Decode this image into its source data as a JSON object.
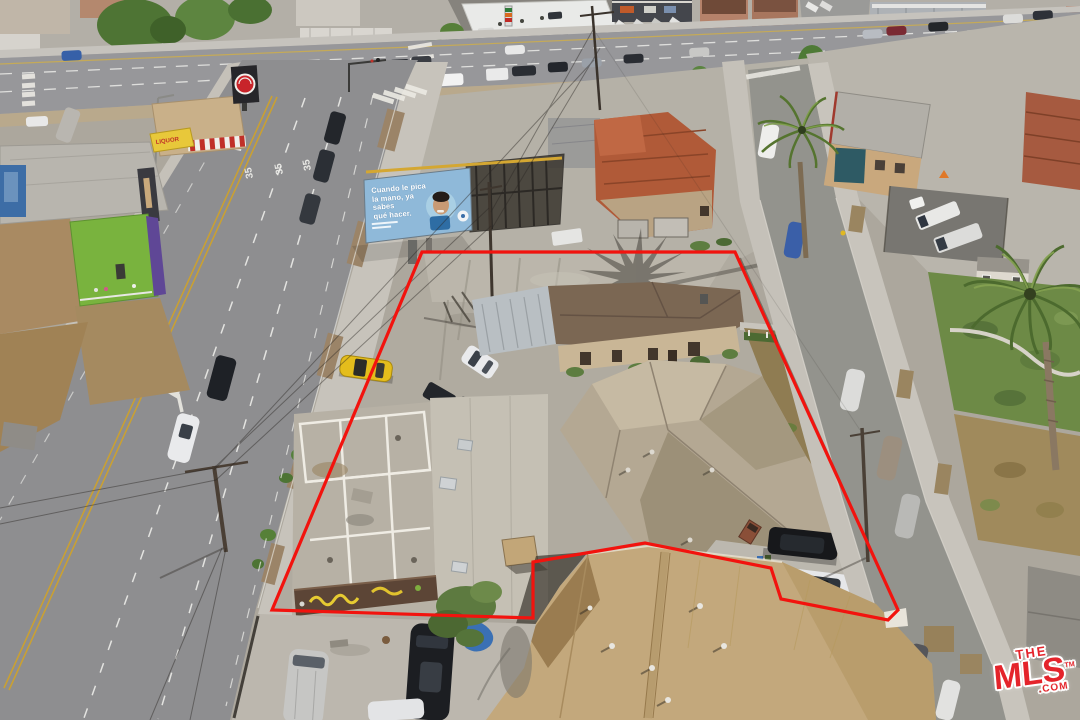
{
  "scene": {
    "title": "Aerial drone photo of corner commercial property with outlined lot lines",
    "width": 1080,
    "height": 720
  },
  "property_outline": {
    "color": "#f2130e",
    "points": "422,252 735,252 898,610 888,620 781,599 771,568 645,543 533,562 533,618 272,610"
  },
  "watermark": {
    "the": "THE",
    "mls": "MLS",
    "tm": "TM",
    "com": ".COM",
    "color": "#e4242b"
  },
  "billboard": {
    "line1": "Cuando le pica",
    "line2": "la mano, ya sabes",
    "line3": "qué hacer.",
    "bg_color": "#8fb9d9"
  },
  "road_markings": {
    "speed_limit": "35"
  },
  "signs": {
    "liquor": "LIQUOR"
  },
  "palette": {
    "asphalt": "#8e8e90",
    "boulevard": "#97979a",
    "concrete": "#c7c3bb",
    "dirt_lot": "#b0aba0",
    "main_roof": "#b4a893",
    "bottom_roof": "#c3a87c",
    "lawn": "#6d8a46",
    "palm": "#4c6a2e",
    "yellow_car": "#e4bd1c"
  }
}
